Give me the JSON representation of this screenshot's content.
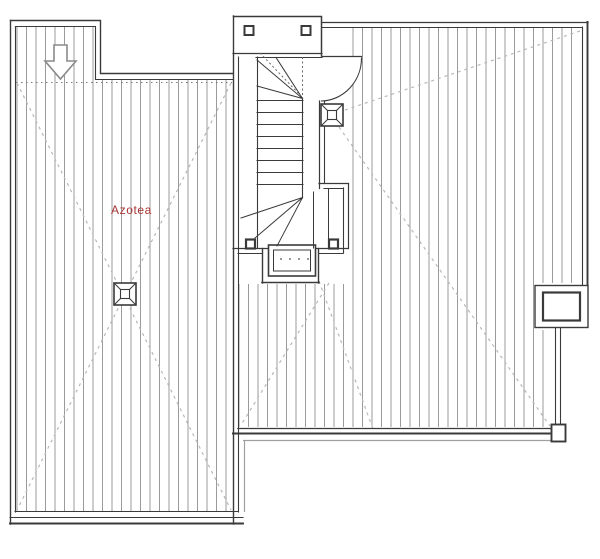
{
  "plan": {
    "room_label": "Azotea",
    "room_label_color": "#a83434",
    "colors": {
      "walls": "#3a3a3a",
      "hatch": "#9b9b9b",
      "slope_dash": "#b8b8b8",
      "secondary_line": "#9f9f9f",
      "background": "#ffffff"
    },
    "symbols": {
      "direction_arrow": "down-arrow",
      "roof_drain_count": 2,
      "stair_type": "u-shaped-stair",
      "door_swing": "arc",
      "skylight_dot_count": 4,
      "newel_post_count": 2,
      "chimney": "rect-outlet"
    }
  }
}
